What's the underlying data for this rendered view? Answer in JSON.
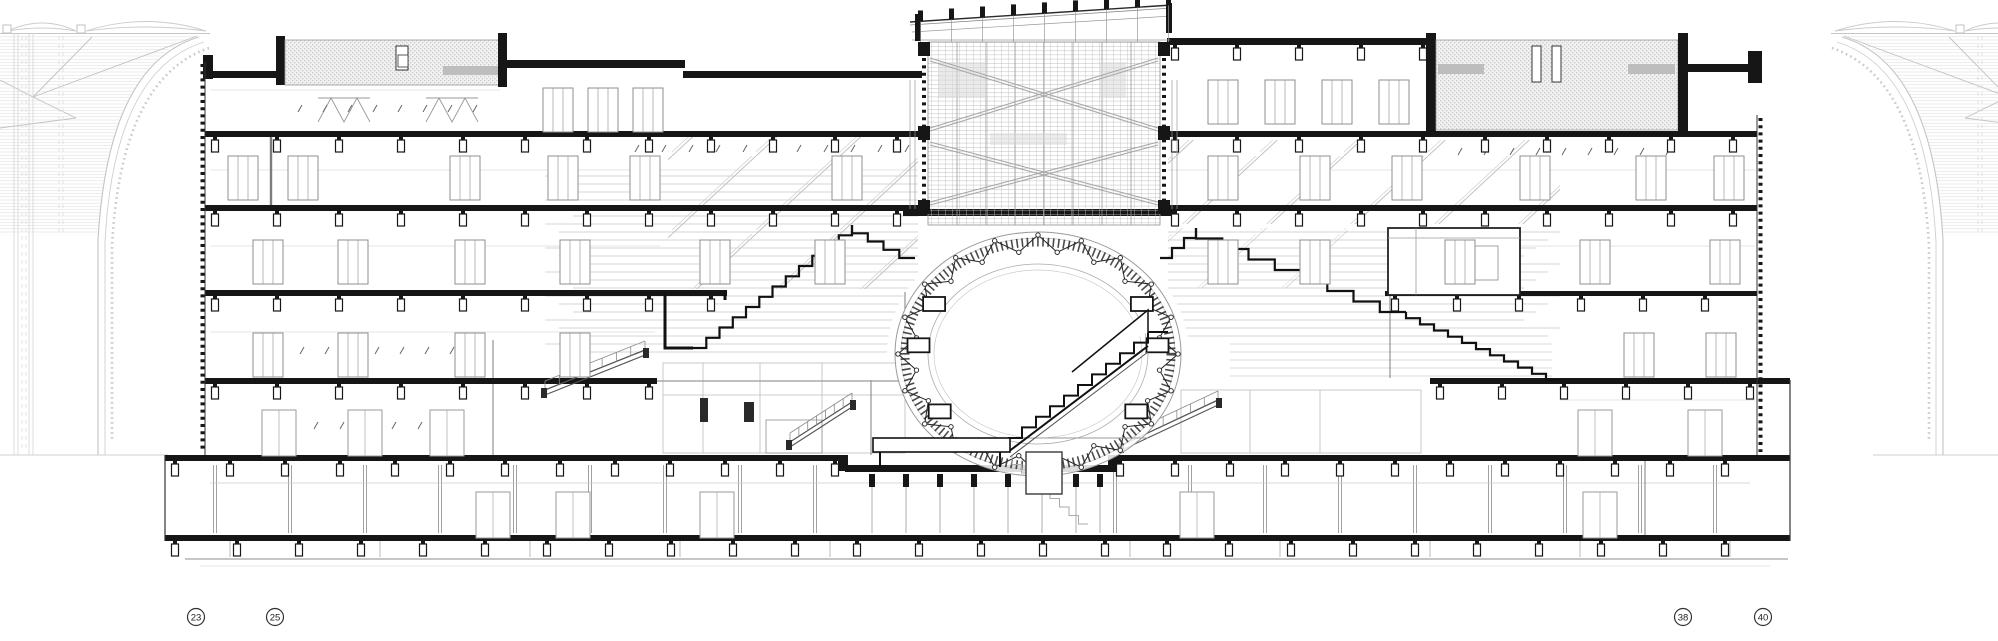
{
  "grid_bubbles": [
    {
      "label": "23"
    },
    {
      "label": "25"
    },
    {
      "label": "38"
    },
    {
      "label": "40"
    }
  ],
  "palette": {
    "ink": "#141414",
    "mid": "#8a8a8a",
    "light": "#c6c6c6",
    "context": "#d9d9d9",
    "paper": "#ffffff"
  }
}
